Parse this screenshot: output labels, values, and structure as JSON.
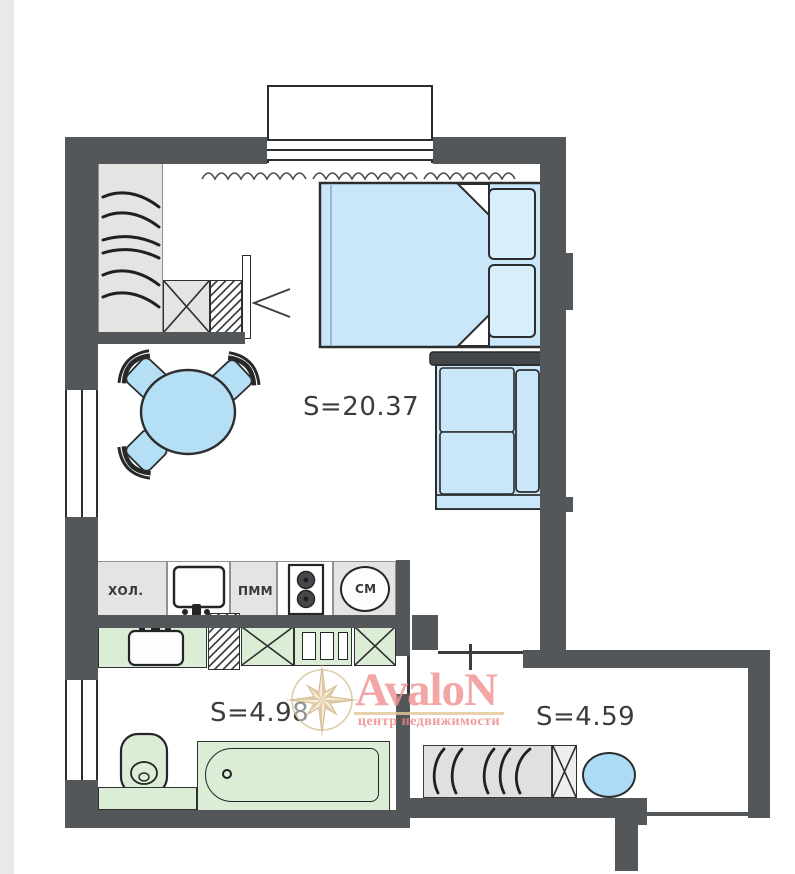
{
  "rooms": {
    "living_room": {
      "area_label": "S=20.37"
    },
    "bathroom": {
      "area_label": "S=4.98"
    },
    "hallway": {
      "area_label": "S=4.59"
    }
  },
  "kitchen": {
    "fridge_label": "ХОЛ.",
    "dishwasher_label": "ПММ",
    "washing_machine_label": "СМ"
  },
  "watermark": {
    "brand": "AvaloN",
    "tagline": "центр недвижимости"
  },
  "colors": {
    "wall": "#54575a",
    "furniture_blue": "#c9e7f8",
    "accent_blue": "#abdbf5",
    "fixture_green": "#dcedd6",
    "cabinet_gray": "#e4e4e3",
    "brand_pink": "#f09393",
    "brand_gold": "#dcc49c",
    "label_text": "#3a3c3e"
  }
}
